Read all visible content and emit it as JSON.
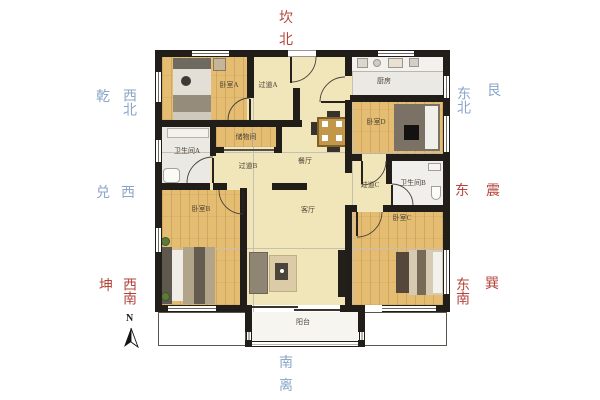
{
  "compass": {
    "north": {
      "trigram": "坎",
      "direction": "北"
    },
    "south": {
      "trigram": "离",
      "direction": "南"
    },
    "west": {
      "trigram": "兑",
      "direction": "西"
    },
    "east": {
      "trigram": "震",
      "direction": "东"
    },
    "northwest": {
      "trigram": "乾",
      "direction": "西北"
    },
    "northeast": {
      "trigram": "艮",
      "direction": "东北"
    },
    "southwest": {
      "trigram": "坤",
      "direction": "西南"
    },
    "southeast": {
      "trigram": "巽",
      "direction": "东南"
    },
    "north_arrow_label": "N"
  },
  "floorplan": {
    "rooms": {
      "bedroom_a": {
        "label": "卧室A"
      },
      "corridor_a": {
        "label": "过道A"
      },
      "kitchen": {
        "label": "厨房"
      },
      "bedroom_d": {
        "label": "卧室D"
      },
      "storage": {
        "label": "储物间"
      },
      "bathroom_a": {
        "label": "卫生间A"
      },
      "corridor_b": {
        "label": "过道B"
      },
      "dining": {
        "label": "餐厅"
      },
      "corridor_c": {
        "label": "过道C"
      },
      "bathroom_b": {
        "label": "卫生间B"
      },
      "living": {
        "label": "客厅"
      },
      "bedroom_b": {
        "label": "卧室B"
      },
      "bedroom_c": {
        "label": "卧室C"
      },
      "balcony": {
        "label": "阳台"
      }
    }
  },
  "colors": {
    "compass_red": "#b5453c",
    "compass_blue": "#8ba6c9",
    "wall": "#211e1a",
    "wood_floor": "#e5bd72",
    "hall_floor": "#f1e5ba",
    "tile_floor": "#eae9e4",
    "room_label_text": "#4a4234"
  }
}
